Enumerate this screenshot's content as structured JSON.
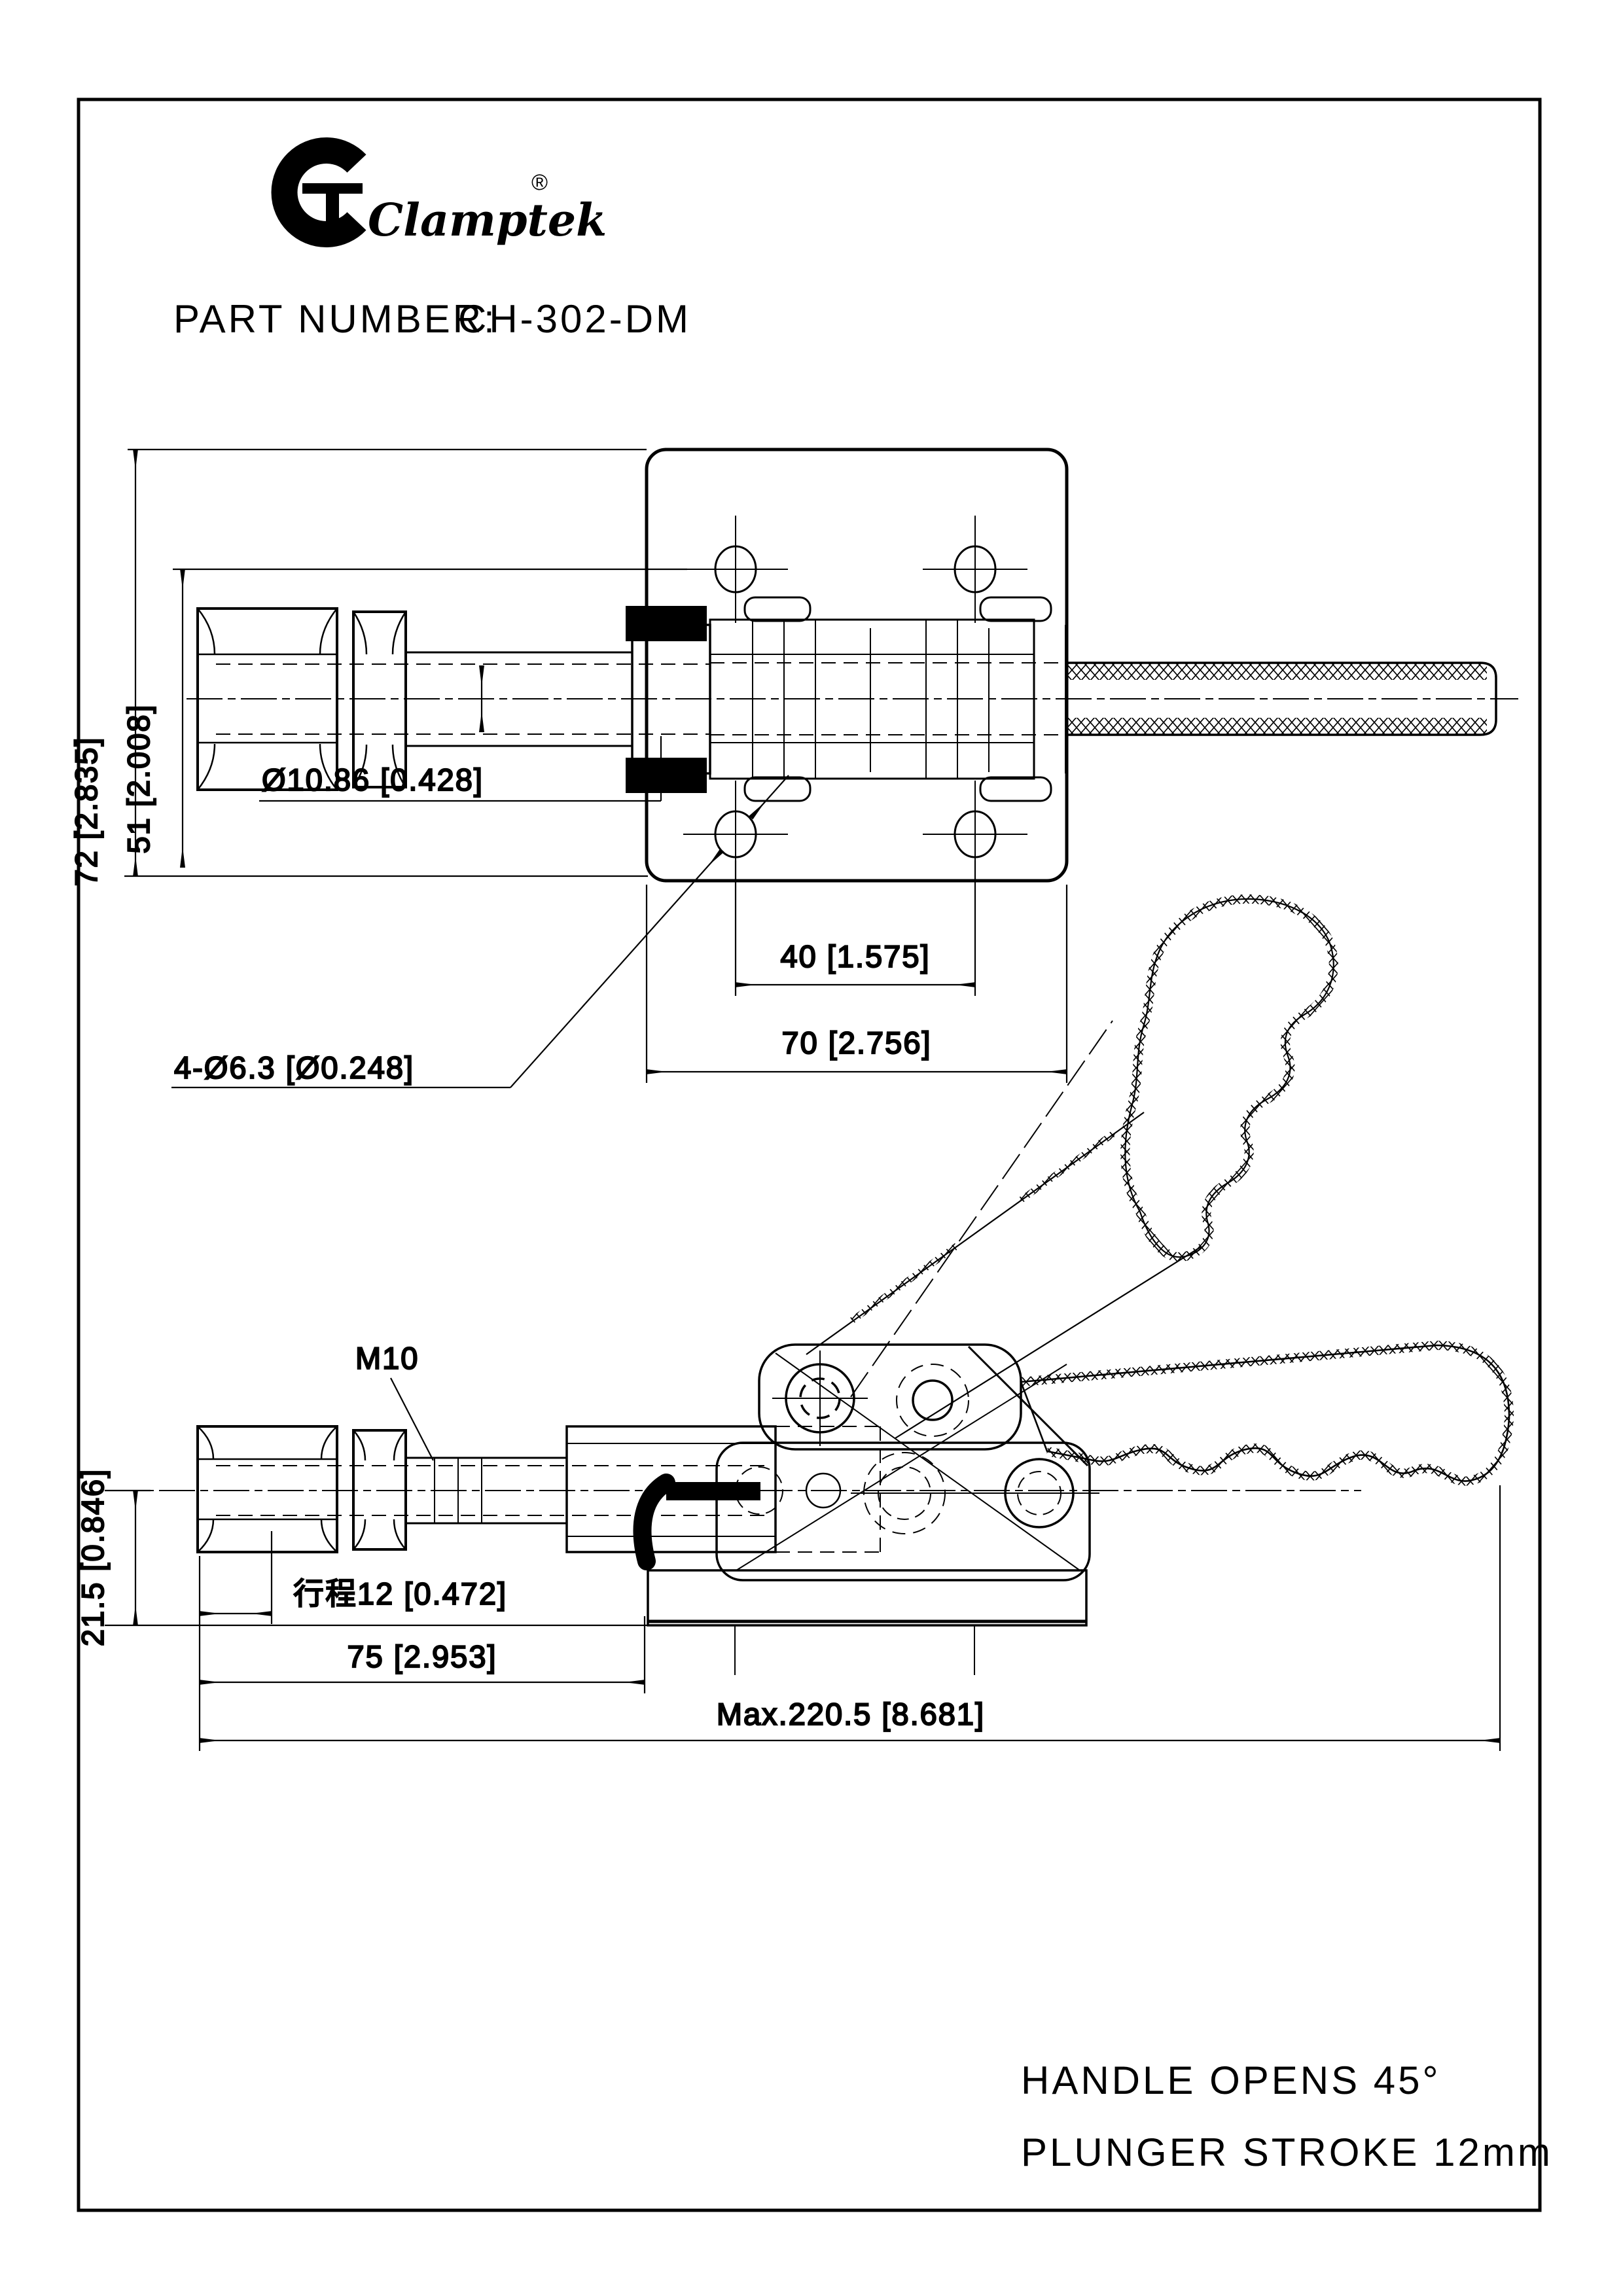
{
  "header": {
    "brand": "Clamptek",
    "registered_mark": "®",
    "part_label": "PART NUMBER:",
    "part_number": "CH-302-DM"
  },
  "top_view": {
    "dims": {
      "overall_height": "72 [2.835]",
      "hole_row_height": "51 [2.008]",
      "plunger_diameter": "Ø10.86 [0.428]",
      "mounting_holes": "4-Ø6.3 [Ø0.248]",
      "hole_spacing": "40 [1.575]",
      "plate_width": "70 [2.756]"
    }
  },
  "side_view": {
    "dims": {
      "thread_callout": "M10",
      "axis_height": "21.5 [0.846]",
      "stroke": "行程12 [0.472]",
      "front_length": "75 [2.953]",
      "overall_length": "Max.220.5 [8.681]"
    }
  },
  "notes": {
    "line1": "HANDLE OPENS 45°",
    "line2": "PLUNGER STROKE 12mm"
  },
  "colors": {
    "ink": "#000000",
    "paper": "#ffffff"
  }
}
